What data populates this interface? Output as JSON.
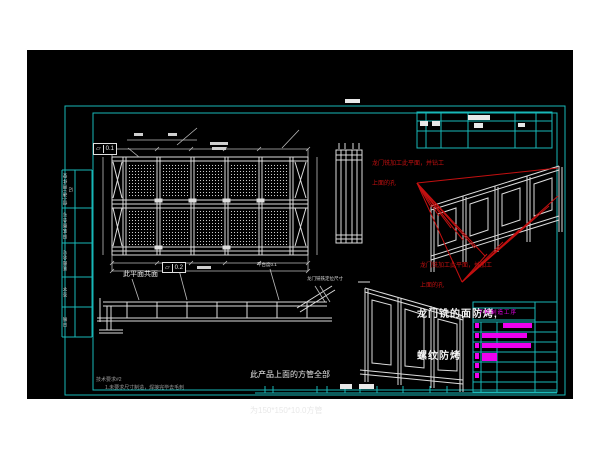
{
  "annotations": {
    "fcf1": {
      "symbol": "⏥",
      "value": "0.1"
    },
    "fcf2": {
      "symbol": "⏥",
      "value": "0.2"
    },
    "coplanar_note": "此平面共面",
    "platform_flatness_note": "平台度0.1",
    "gantry_mill_dim_note": "龙门铣铣定位尺寸",
    "red_note_top_line1": "龙门铣加工此平面，并钻工",
    "red_note_top_line2": "上面的孔",
    "red_note_mid_line1": "龙门铣加工此平面，并加工",
    "red_note_mid_line2": "上面的孔",
    "white_note_line1": "龙门铣的面防烤,",
    "white_note_line2": "螺纹防烤",
    "square_tube_note_line1": "此产品上面的方管全部",
    "square_tube_note_line2": "为150*150*10.0方管",
    "tech_req_title": "技术要求#2",
    "tech_req_item1": "1.未要求尺寸制造，焊接完毕去毛刺"
  },
  "left_strip": {
    "rows": [
      {
        "label": "借(通)用件登记"
      },
      {
        "label": "旧底图总号"
      },
      {
        "label": "底图总号"
      },
      {
        "label": "签字"
      },
      {
        "label": "日期"
      }
    ]
  },
  "bom": {
    "header": "下料制造工序"
  },
  "colors": {
    "frame_cyan": "#18b8b8",
    "annotation_red": "#c41010",
    "bom_magenta": "#ee00ee",
    "line_white": "#dcdcdc"
  }
}
